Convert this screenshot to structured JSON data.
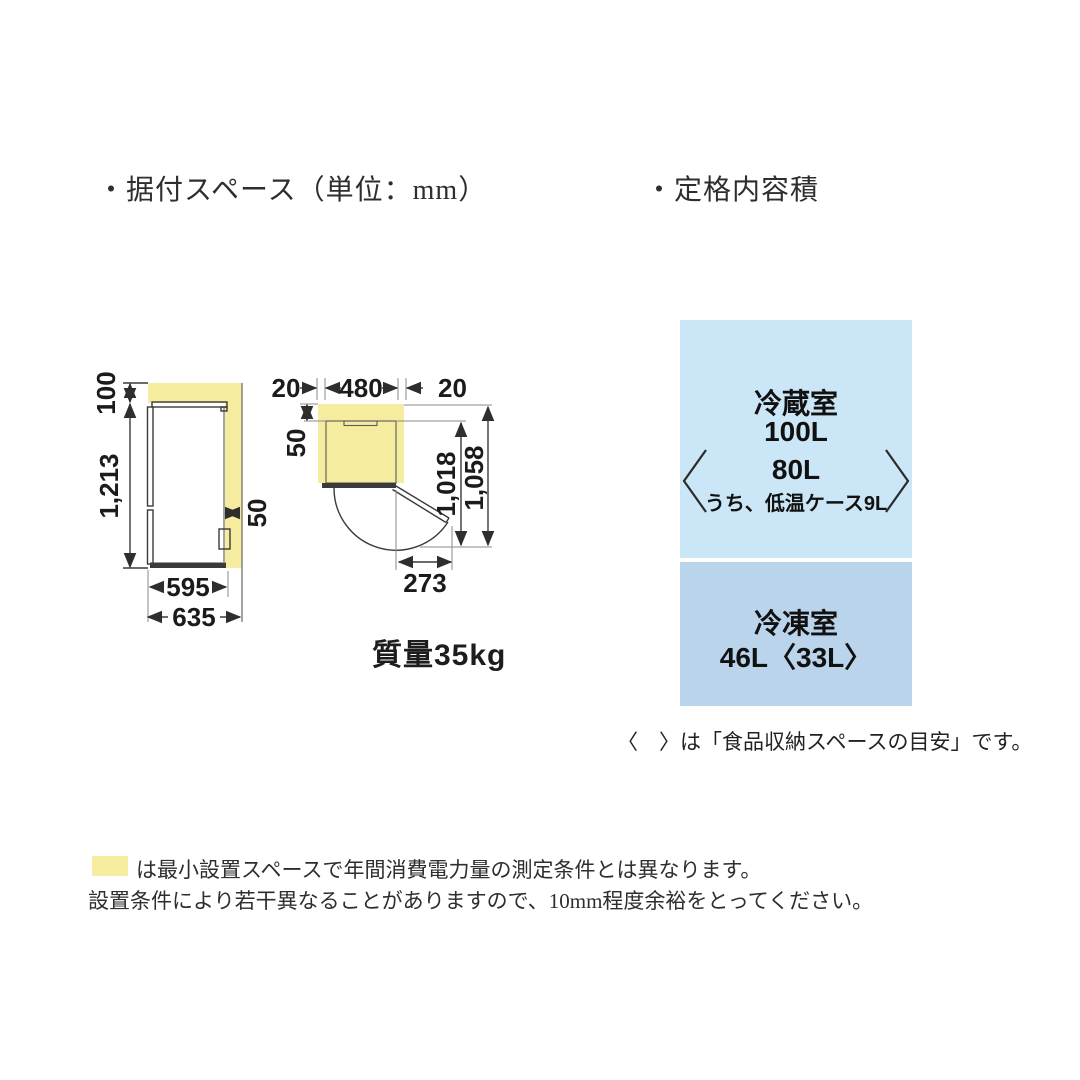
{
  "sections": {
    "installation_title": "・据付スペース（単位：mm）",
    "capacity_title": "・定格内容積"
  },
  "diagram": {
    "side_view": {
      "top_clearance": "100",
      "height": "1,213",
      "rear_clearance": "50",
      "depth": "595",
      "total_depth": "635"
    },
    "top_view": {
      "left_clearance": "20",
      "width": "480",
      "right_clearance": "20",
      "rear_clearance": "50",
      "open_door_depth": "1,018",
      "total_depth": "1,058",
      "door_swing": "273"
    },
    "mass": "質量35kg"
  },
  "capacity": {
    "fridge": {
      "name": "冷蔵室",
      "total": "100L",
      "storage": "80L",
      "storage_note": "うち、低温ケース9L"
    },
    "freezer": {
      "name": "冷凍室",
      "value": "46L〈33L〉"
    },
    "bracket_note": "〈　〉は「食品収納スペースの目安」です。"
  },
  "footnote": {
    "line1": "は最小設置スペースで年間消費電力量の測定条件とは異なります。",
    "line2": "設置条件により若干異なることがありますので、10mm程度余裕をとってください。"
  },
  "colors": {
    "highlight_yellow": "#F6EC9F",
    "fridge_box_blue": "#CBE6F6",
    "freezer_box_blue": "#BAD4EC"
  }
}
